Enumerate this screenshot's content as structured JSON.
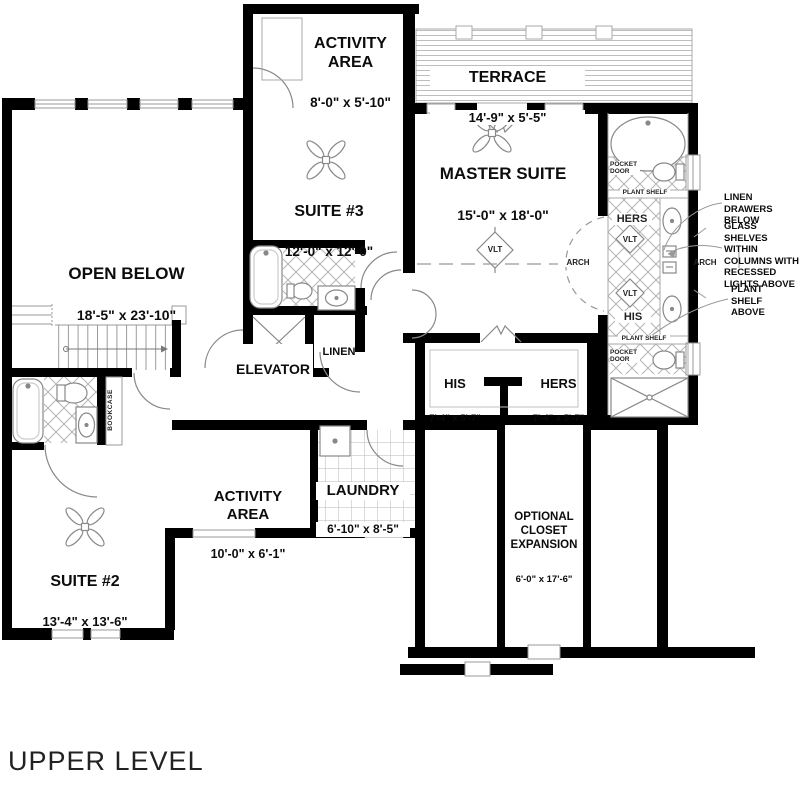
{
  "title": "UPPER LEVEL",
  "rooms": {
    "activity_upper": {
      "name": "ACTIVITY\nAREA",
      "dims": "8'-0\" x 5'-10\""
    },
    "terrace": {
      "name": "TERRACE",
      "dims": "14'-9\" x 5'-5\""
    },
    "master": {
      "name": "MASTER SUITE",
      "dims": "15'-0\" x 18'-0\""
    },
    "suite3": {
      "name": "SUITE #3",
      "dims": "12'-0\" x 12'-0\""
    },
    "open_below": {
      "name": "OPEN BELOW",
      "dims": "18'-5\" x 23'-10\""
    },
    "elevator": {
      "name": "ELEVATOR"
    },
    "linen": {
      "name": "LINEN"
    },
    "his_closet": {
      "name": "HIS",
      "dims": "7'-4\" x 5'-7\""
    },
    "hers_closet": {
      "name": "HERS",
      "dims": "7'-4\" x 5'-7\""
    },
    "activity_lower": {
      "name": "ACTIVITY\nAREA",
      "dims": "10'-0\" x 6'-1\""
    },
    "laundry": {
      "name": "LAUNDRY",
      "dims": "6'-10\" x 8'-5\""
    },
    "suite2": {
      "name": "SUITE #2",
      "dims": "13'-4\" x 13'-6\""
    },
    "optional_closet": {
      "name": "OPTIONAL\nCLOSET\nEXPANSION",
      "dims": "6'-0\" x 17'-6\""
    }
  },
  "bath": {
    "hers": "HERS",
    "his": "HIS",
    "vlt": "VLT",
    "plant_shelf": "PLANT SHELF",
    "pocket_door": "POCKET\nDOOR",
    "arch": "ARCH",
    "bookcase": "BOOKCASE"
  },
  "annotations": {
    "linen_drawers": "LINEN DRAWERS\nBELOW",
    "glass_shelves": "GLASS SHELVES\nWITHIN\nCOLUMNS WITH\nRECESSED\nLIGHTS ABOVE",
    "plant_shelf_above": "PLANT\nSHELF\nABOVE"
  },
  "colors": {
    "wall": "#000000",
    "thin_line": "#8a8a8a",
    "tile_line": "#b0b0b0",
    "text": "#0c0c0c",
    "background": "#ffffff"
  }
}
